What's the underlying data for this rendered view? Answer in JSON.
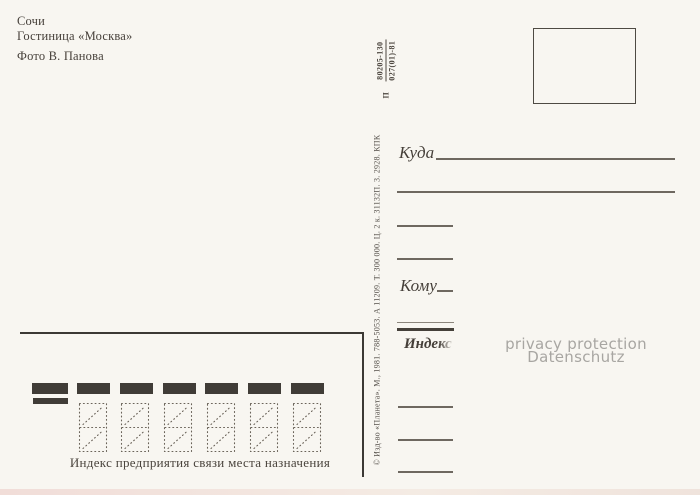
{
  "caption": {
    "lines": [
      "Сочи",
      "Гостиница «Москва»",
      "Фото В. Панова"
    ]
  },
  "imprint": {
    "prefix": "П",
    "code_numerator": "80205-130",
    "code_denominator": "027(01)-81",
    "copyright_line": "© Изд-во «Планета». М., 1981. 788-5053. А 11209. Т. 300 000. Ц. 2 к. 31132П. 3. 2928. КПК"
  },
  "address": {
    "kuda_label": "Куда",
    "komu_label": "Кому",
    "index_label": "Индекс"
  },
  "index_zone": {
    "caption": "Индекс предприятия связи места назначения",
    "marker_bars": 7,
    "digit_cells": 6
  },
  "watermark": {
    "lines": [
      "privacy protection",
      "Datenschutz"
    ]
  },
  "colors": {
    "background": "#f8f6f1",
    "ink": "#4a443d",
    "line": "#6e6860",
    "bar": "#403c37",
    "frame": "#3c3935",
    "watermark": "#a8a6a2"
  }
}
